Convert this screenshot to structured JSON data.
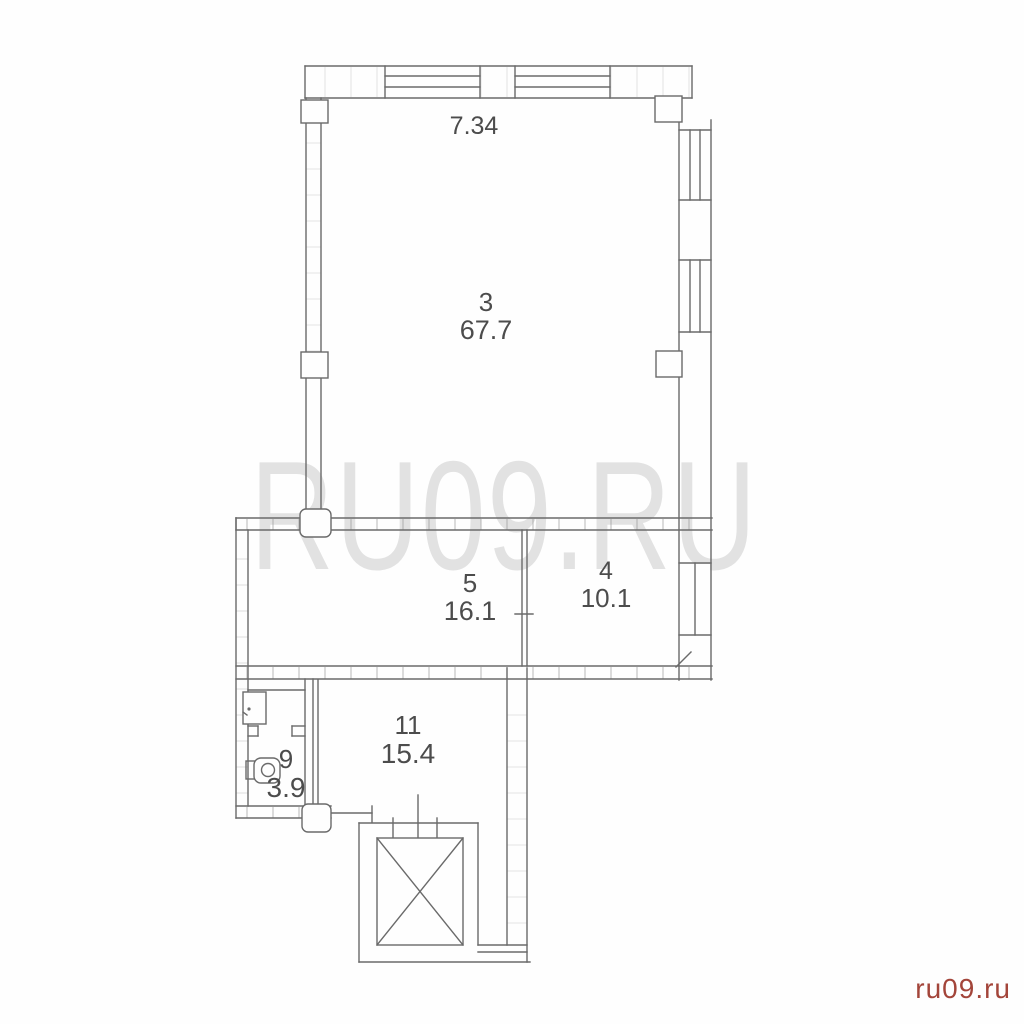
{
  "watermark": {
    "text": "RU09.RU"
  },
  "credit": {
    "text": "ru09.ru"
  },
  "dimensions": {
    "top_width": "7.34"
  },
  "rooms": [
    {
      "number": "3",
      "area": "67.7"
    },
    {
      "number": "5",
      "area": "16.1"
    },
    {
      "number": "4",
      "area": "10.1"
    },
    {
      "number": "9",
      "area": "3.9"
    },
    {
      "number": "11",
      "area": "15.4"
    }
  ],
  "colors": {
    "line": "#6a6a6a",
    "hatch": "#949494",
    "label": "#4c4c4c",
    "watermark": "#e2e2e2",
    "credit": "#a3453a"
  }
}
